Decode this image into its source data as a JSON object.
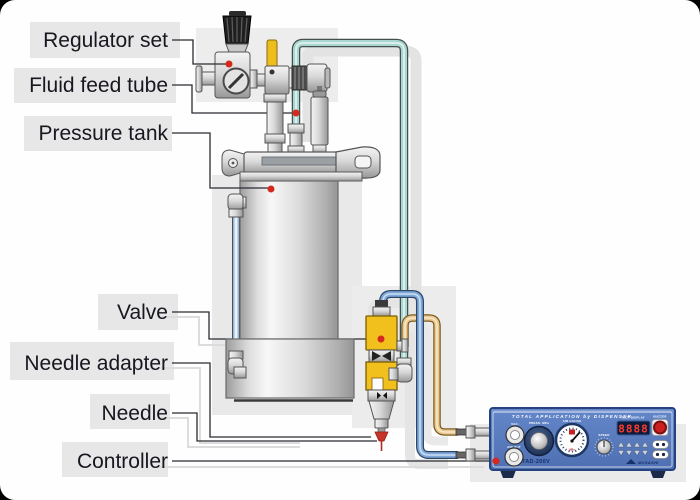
{
  "labels": {
    "regulator": "Regulator set",
    "fluid_tube": "Fluid feed tube",
    "tank": "Pressure tank",
    "valve": "Valve",
    "adapter": "Needle adapter",
    "needle": "Needle",
    "controller": "Controller"
  },
  "controller": {
    "title": "TOTAL APPLICATION by DISPENSER",
    "model": "TAD-200V",
    "port1_label": "VAC.",
    "port2_label": "AIR OUT",
    "pressure_knob_label": "PRESS. MPa",
    "gauge_label": "AIR GAUGE",
    "gauge_unit": "MPa",
    "speed_label": "SPEED",
    "display_label": "TACT DISPLAY",
    "display_value": "8888",
    "buzzer_label": "BUZZER",
    "brand": "MUSASHI"
  },
  "colors": {
    "marker_red": "#d42a1e",
    "valve_yellow": "#f1c01d",
    "fluid_tube_teal": "#a9d6d0",
    "air_tube_blue": "#7fa8d9",
    "vacuum_tube_tan": "#eac88f",
    "controller_blue": "#5c7fc0",
    "label_text": "#17171f"
  }
}
